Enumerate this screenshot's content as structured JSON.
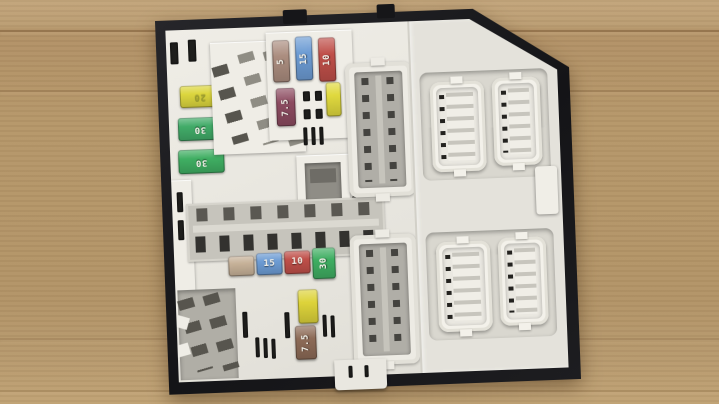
{
  "scene": {
    "description": "Used automotive engine-bay fuse box / body control module lying on cardboard",
    "background_color": "#b49568"
  },
  "unit": {
    "base_color": "#17181a",
    "cover_color": "#e9e7e0",
    "panel_color": "#e3e1da",
    "recess_color": "#d9d7cf",
    "connector_color": "#f2f0e9",
    "socket_gray": "#8f8d86"
  },
  "fuses": {
    "left_column": [
      {
        "value": "20",
        "color": "#dcd63e"
      },
      {
        "value": "30",
        "color": "#41ab68"
      },
      {
        "value": "30",
        "color": "#3fae62"
      }
    ],
    "top_row": [
      {
        "value": "5",
        "color": "#ab8d7f"
      },
      {
        "value": "15",
        "color": "#6d9cd4"
      },
      {
        "value": "10",
        "color": "#bf4f49"
      }
    ],
    "top_lower": [
      {
        "value": "7.5",
        "color": "#8c4b60"
      },
      {
        "value": "",
        "color": "#e0d93e"
      }
    ],
    "middle_row": [
      {
        "value": "",
        "color": "#c6b198"
      },
      {
        "value": "15",
        "color": "#6d9cd4"
      },
      {
        "value": "10",
        "color": "#bf4f49"
      },
      {
        "value": "30",
        "color": "#3fae62"
      }
    ],
    "bottom_column": [
      {
        "value": "",
        "color": "#ddd33a"
      },
      {
        "value": "7.5",
        "color": "#8d6b57"
      }
    ]
  }
}
